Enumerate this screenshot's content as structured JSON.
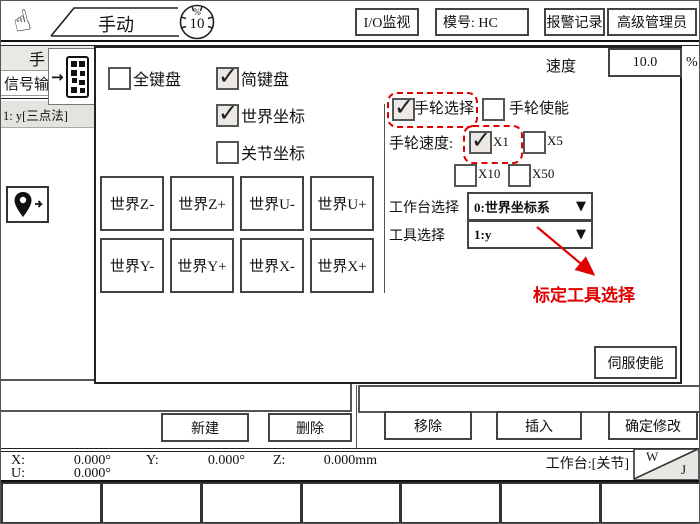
{
  "toolbar": {
    "mode": "手动",
    "gauge_value": "10",
    "gauge_unit": "%",
    "io_button": "I/O监视",
    "model_button": "模号: HC",
    "alarm_button": "报警记录",
    "admin_button": "高级管理员"
  },
  "speed": {
    "label": "速度",
    "value": "10.0",
    "unit": "%"
  },
  "sidebar": {
    "tab_hand": "手",
    "tab_signal": "信号输",
    "selected_item": "1: y[三点法]"
  },
  "panel": {
    "keyboard": {
      "full": "全键盘",
      "simple": "简键盘",
      "world": "世界坐标",
      "joint": "关节坐标"
    },
    "jog": [
      "世界Z-",
      "世界Z+",
      "世界U-",
      "世界U+",
      "世界Y-",
      "世界Y+",
      "世界X-",
      "世界X+"
    ],
    "handwheel": {
      "select": "手轮选择",
      "enable": "手轮使能",
      "speed": "手轮速度:",
      "x1": "X1",
      "x5": "X5",
      "x10": "X10",
      "x50": "X50"
    },
    "workbench": {
      "label": "工作台选择",
      "value": "0:世界坐标系"
    },
    "tool": {
      "label": "工具选择",
      "value": "1:y"
    },
    "annotation": "标定工具选择",
    "servo": "伺服使能"
  },
  "checks": {
    "full": false,
    "simple": true,
    "world": true,
    "joint": false,
    "hw_select": true,
    "hw_enable": false,
    "x1": true,
    "x5": false,
    "x10": false,
    "x50": false
  },
  "actions": {
    "new": "新建",
    "delete": "删除",
    "remove": "移除",
    "insert": "插入",
    "confirm": "确定修改"
  },
  "status": {
    "x_label": "X:",
    "x": "0.000°",
    "y_label": "Y:",
    "y": "0.000°",
    "z_label": "Z:",
    "z": "0.000mm",
    "u_label": "U:",
    "u": "0.000°",
    "workbench": "工作台:[关节]",
    "w": "W",
    "j": "J"
  },
  "icons": {
    "dropdown": "▼",
    "arrow_right": "→",
    "hand_pointer": "☝"
  },
  "colors": {
    "accent_red": "#e00000"
  }
}
